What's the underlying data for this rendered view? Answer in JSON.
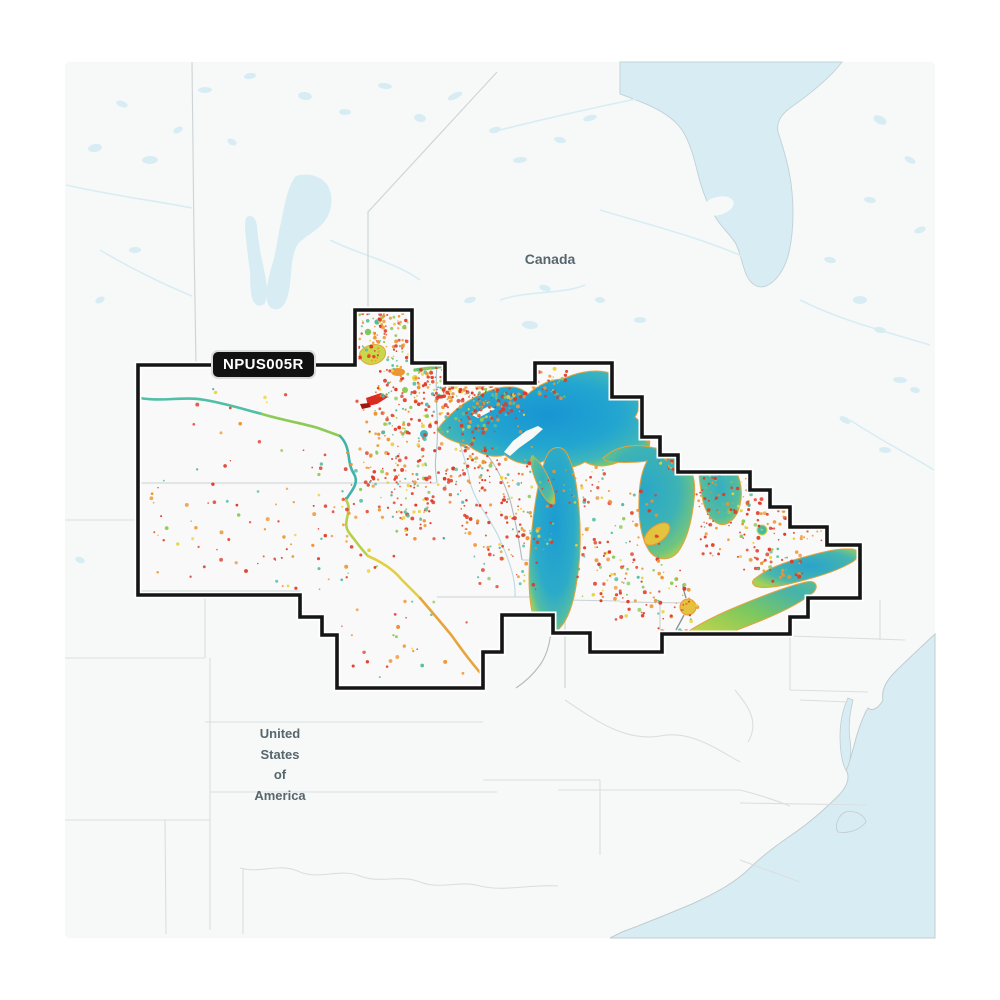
{
  "product": {
    "region_code": "NPUS005R"
  },
  "labels": {
    "canada": "Canada",
    "united_states": "United\nStates\nof\nAmerica"
  },
  "palette": {
    "map_background": "#f7f9f9",
    "canada_shallow_water": "#d8edf3",
    "coverage_outline": "#151515",
    "badge_background": "#111111",
    "badge_text": "#ffffff",
    "label_text": "#57666d",
    "depth_deep": "#1795d3",
    "depth_mid": "#31b0c9",
    "depth_teal": "#52bda4",
    "depth_green": "#8ccb55",
    "depth_yellow": "#e8d43c",
    "depth_orange": "#ef9433",
    "depth_red": "#e03a26"
  }
}
